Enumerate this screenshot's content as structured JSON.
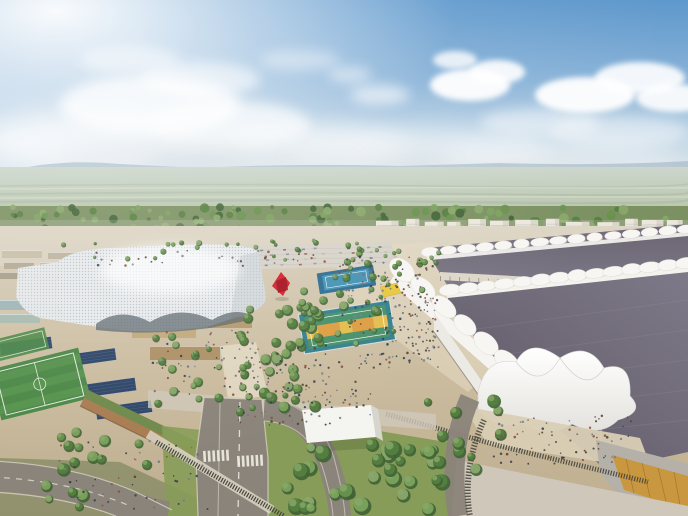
{
  "meta": {
    "scene": "aerial-architectural-rendering",
    "subject": "expo campus: white lattice pavilion, central park with sports courts, red sculpture, long exhibition halls with white tent roofs, apartment row on horizon, roads and gardens in foreground"
  },
  "seed": 20240717,
  "palette": {
    "skyTop": "#5e98cc",
    "skyMid": "#8ab3d8",
    "skyLow": "#c6d9e6",
    "skyHaze": "#e2eaee",
    "cloudGray": "#b9c6ce",
    "mountain": "#a9bbc7",
    "plainA": "#ccd6cc",
    "plainB": "#b2bfa1",
    "plainStreak": "#9cae92",
    "plainLight": "#e0e4d4",
    "forestBase": "#7c9162",
    "forestDark": "#5c744a",
    "aptWall": "#e9e4d8",
    "aptShade": "#c7c0b1",
    "aptWin": "#9aa1a9",
    "ground1": "#d8cfbc",
    "ground2": "#cbbc9f",
    "ground3": "#bfae90",
    "parking": "#d7d3c9",
    "parkLine": "#c3bfb4",
    "lattice": "#e8ebed",
    "latticeDot": "#98a1a8",
    "latticeShade": "#bfc7cc",
    "latticeDark": "#5d686e",
    "corridor": "#ddd7c9",
    "corridorCol": "#8d8678",
    "roofDark": "#57525f",
    "roofMid": "#6e6876",
    "roofLight": "#7e7988",
    "roofRidge": "#948e9e",
    "tentWhite": "#f7f6f3",
    "tentShade": "#d5d3cd",
    "hallWall": "#eceae4",
    "concrete": "#b5b1a8",
    "goldGlass": "#c9973f",
    "goldDark": "#8a6224",
    "plazaTan": "#d9cdb4",
    "paveLight": "#cfc8ba",
    "plazaBright": "#e2d8c2",
    "asphalt": "#8b847a",
    "curb": "#d8d2c4",
    "roadMark": "#efede6",
    "grass": "#879c58",
    "grassDark": "#6d8347",
    "hedge": "#6e7a52",
    "fenceDark": "#44453c",
    "fieldGreen": "#4c8847",
    "fieldLight": "#5e9a52",
    "solar": "#2f4566",
    "solarLine": "#49648c",
    "terracotta": "#a97c52",
    "vegRoof": "#6f8a4c",
    "greenhouse": "#9fb4b4",
    "courtBlueDark": "#2f6e92",
    "courtBlue": "#4493b4",
    "courtTeal": "#35818f",
    "courtGreen": "#47906a",
    "courtYellow": "#e3bd4e",
    "courtOrange": "#dd9a41",
    "red": "#d5202d",
    "redDark": "#a31220",
    "yellowCanopy": "#e8c83e",
    "boxWhite": "#f4f4f0",
    "boxShade": "#d6d6cf"
  },
  "clouds": [
    {
      "cx": 470,
      "cy": 85,
      "rx": 40,
      "ry": 16,
      "o": 0.95,
      "b": 3
    },
    {
      "cx": 497,
      "cy": 72,
      "rx": 28,
      "ry": 12,
      "o": 0.9,
      "b": 3
    },
    {
      "cx": 585,
      "cy": 95,
      "rx": 50,
      "ry": 18,
      "o": 0.95,
      "b": 3
    },
    {
      "cx": 640,
      "cy": 78,
      "rx": 45,
      "ry": 16,
      "o": 0.9,
      "b": 3
    },
    {
      "cx": 674,
      "cy": 98,
      "rx": 38,
      "ry": 14,
      "o": 0.9,
      "b": 3
    },
    {
      "cx": 455,
      "cy": 60,
      "rx": 22,
      "ry": 9,
      "o": 0.8,
      "b": 3
    },
    {
      "cx": 380,
      "cy": 95,
      "rx": 30,
      "ry": 10,
      "o": 0.6,
      "b": 6
    },
    {
      "cx": 350,
      "cy": 75,
      "rx": 22,
      "ry": 8,
      "o": 0.5,
      "b": 6
    },
    {
      "cx": 540,
      "cy": 122,
      "rx": 60,
      "ry": 14,
      "o": 0.5,
      "b": 6
    },
    {
      "cx": 620,
      "cy": 132,
      "rx": 70,
      "ry": 16,
      "o": 0.45,
      "b": 6
    },
    {
      "cx": 150,
      "cy": 105,
      "rx": 90,
      "ry": 30,
      "o": 0.8,
      "b": 6
    },
    {
      "cx": 230,
      "cy": 125,
      "rx": 80,
      "ry": 24,
      "o": 0.7,
      "b": 6
    },
    {
      "cx": 90,
      "cy": 140,
      "rx": 110,
      "ry": 28,
      "o": 0.75,
      "b": 12
    },
    {
      "cx": 290,
      "cy": 150,
      "rx": 120,
      "ry": 26,
      "o": 0.6,
      "b": 12
    },
    {
      "cx": 420,
      "cy": 152,
      "rx": 130,
      "ry": 24,
      "o": 0.5,
      "b": 12
    },
    {
      "cx": 560,
      "cy": 162,
      "rx": 120,
      "ry": 20,
      "o": 0.45,
      "b": 12
    },
    {
      "cx": 200,
      "cy": 80,
      "rx": 60,
      "ry": 18,
      "o": 0.6,
      "b": 6
    },
    {
      "cx": 300,
      "cy": 60,
      "rx": 40,
      "ry": 10,
      "o": 0.4,
      "b": 6
    },
    {
      "cx": 130,
      "cy": 60,
      "rx": 50,
      "ry": 14,
      "o": 0.5,
      "b": 6
    },
    {
      "cx": 300,
      "cy": 162,
      "rx": 150,
      "ry": 13,
      "o": 0.3,
      "b": 12,
      "g": 1
    },
    {
      "cx": 520,
      "cy": 168,
      "rx": 150,
      "ry": 11,
      "o": 0.28,
      "b": 12,
      "g": 1
    },
    {
      "cx": 150,
      "cy": 152,
      "rx": 100,
      "ry": 12,
      "o": 0.3,
      "b": 12,
      "g": 1
    }
  ],
  "forest": {
    "x1": 0,
    "x2": 688,
    "yTop": 207,
    "yBot": 236,
    "n": 160
  },
  "apartments": {
    "x1": 376,
    "x2": 688,
    "baseY": 233,
    "minW": 12,
    "maxW": 24,
    "minH": 9,
    "maxH": 15,
    "minGap": 3,
    "maxGap": 8,
    "frontTrees": 46
  },
  "parking": {
    "rows": [
      {
        "x1": 138,
        "y1": 253,
        "x2": 392,
        "y2": 247
      },
      {
        "x1": 135,
        "y1": 258,
        "x2": 396,
        "y2": 252
      },
      {
        "x1": 131,
        "y1": 263,
        "x2": 398,
        "y2": 257
      },
      {
        "x1": 127,
        "y1": 268,
        "x2": 400,
        "y2": 262
      }
    ],
    "perRow": 15,
    "carColors": [
      "#aaa9a4",
      "#8f949c",
      "#b9b4a9",
      "#7c828c",
      "#c2bdb2",
      "#6d7480",
      "#9a5f52"
    ]
  },
  "leftBlocks": [
    {
      "x": 2,
      "y": 250,
      "w": 40,
      "h": 8,
      "c": "#c9bfa8"
    },
    {
      "x": 48,
      "y": 252,
      "w": 34,
      "h": 7,
      "c": "#bdb49e"
    },
    {
      "x": 4,
      "y": 262,
      "w": 30,
      "h": 7,
      "c": "#b3ab95"
    },
    {
      "x": 40,
      "y": 262,
      "w": 26,
      "h": 6,
      "c": "#c4bba4"
    },
    {
      "x": 0,
      "y": 272,
      "w": 26,
      "h": 7,
      "c": "#a99f88"
    },
    {
      "x": 30,
      "y": 274,
      "w": 34,
      "h": 7,
      "c": "#b8ae96"
    },
    {
      "x": 70,
      "y": 260,
      "w": 22,
      "h": 6,
      "c": "#c0b79f"
    },
    {
      "x": 96,
      "y": 254,
      "w": 26,
      "h": 6,
      "c": "#cdc4ac"
    },
    {
      "x": 0,
      "y": 300,
      "w": 46,
      "h": 10,
      "c": "#9fb4b6"
    },
    {
      "x": 0,
      "y": 314,
      "w": 40,
      "h": 9,
      "c": "#a9bcb0"
    },
    {
      "x": 50,
      "y": 306,
      "w": 36,
      "h": 9,
      "c": "#95aaa8"
    },
    {
      "x": 132,
      "y": 322,
      "w": 64,
      "h": 16,
      "c": "#c2a97c"
    },
    {
      "x": 208,
      "y": 316,
      "w": 44,
      "h": 12,
      "c": "#b59a6e"
    },
    {
      "x": 150,
      "y": 346,
      "w": 70,
      "h": 14,
      "c": "#ad9166"
    }
  ],
  "solarGroups": [
    {
      "x": 0,
      "y": 340,
      "w": 52,
      "h": 12,
      "rot": -8
    },
    {
      "x": 58,
      "y": 352,
      "w": 58,
      "h": 12,
      "rot": -8
    },
    {
      "x": 6,
      "y": 368,
      "w": 58,
      "h": 13,
      "rot": -8
    },
    {
      "x": 70,
      "y": 382,
      "w": 66,
      "h": 13,
      "rot": -8
    },
    {
      "x": 0,
      "y": 396,
      "w": 40,
      "h": 12,
      "rot": -8
    },
    {
      "x": 96,
      "y": 404,
      "w": 56,
      "h": 12,
      "rot": -8
    }
  ],
  "tentBands": [
    {
      "x1": 430,
      "y1": 252,
      "x2": 686,
      "y2": 229,
      "n": 15,
      "rx": 8.5,
      "ry": 4.5
    },
    {
      "x1": 450,
      "y1": 290,
      "x2": 686,
      "y2": 263,
      "n": 14,
      "rx": 10,
      "ry": 5.5
    },
    {
      "x1": 402,
      "y1": 270,
      "x2": 528,
      "y2": 380,
      "n": 7,
      "rx": 14,
      "ry": 9
    }
  ],
  "corridor": {
    "x1": 440,
    "y1": 276,
    "x2": 622,
    "y2": 286,
    "n": 20
  },
  "crosswalks": [
    {
      "x": 203,
      "y": 451,
      "n": 6,
      "dx": 4.6,
      "w": 2.6,
      "h": 11,
      "rot": -3
    },
    {
      "x": 237,
      "y": 456,
      "n": 6,
      "dx": 4.6,
      "w": 2.6,
      "h": 11,
      "rot": -3
    }
  ],
  "treePalette": [
    "#3f6335",
    "#54803f",
    "#68924e",
    "#7ba35c",
    "#8aa86b"
  ],
  "treeClusters": [
    {
      "x": 240,
      "y": 300,
      "w": 80,
      "h": 108,
      "n": 42,
      "rmin": 3,
      "rmax": 6
    },
    {
      "x": 330,
      "y": 252,
      "w": 100,
      "h": 50,
      "n": 22,
      "rmin": 2,
      "rmax": 4
    },
    {
      "x": 296,
      "y": 290,
      "w": 100,
      "h": 60,
      "n": 16,
      "rmin": 2.5,
      "rmax": 5
    },
    {
      "x": 150,
      "y": 330,
      "w": 110,
      "h": 90,
      "n": 18,
      "rmin": 2.5,
      "rmax": 5
    },
    {
      "x": 40,
      "y": 430,
      "w": 120,
      "h": 78,
      "n": 16,
      "rmin": 4,
      "rmax": 7
    },
    {
      "x": 286,
      "y": 428,
      "w": 156,
      "h": 84,
      "n": 30,
      "rmin": 5,
      "rmax": 9
    },
    {
      "x": 420,
      "y": 400,
      "w": 86,
      "h": 70,
      "n": 13,
      "rmin": 4,
      "rmax": 7
    },
    {
      "x": 60,
      "y": 240,
      "w": 330,
      "h": 20,
      "n": 30,
      "rmin": 1.5,
      "rmax": 3
    },
    {
      "x": 388,
      "y": 250,
      "w": 52,
      "h": 40,
      "n": 8,
      "rmin": 2,
      "rmax": 3.5
    }
  ],
  "crowdPalette": [
    "#3a3f4a",
    "#6b6f78",
    "#8a4a3a",
    "#2f3a4f",
    "#7a7f88",
    "#55402e"
  ],
  "crowdRegions": [
    {
      "x": 338,
      "y": 256,
      "w": 100,
      "h": 112,
      "n": 150
    },
    {
      "x": 236,
      "y": 344,
      "w": 95,
      "h": 82,
      "n": 90
    },
    {
      "x": 150,
      "y": 330,
      "w": 108,
      "h": 66,
      "n": 50
    },
    {
      "x": 58,
      "y": 440,
      "w": 150,
      "h": 70,
      "n": 55
    },
    {
      "x": 492,
      "y": 414,
      "w": 140,
      "h": 50,
      "n": 70
    },
    {
      "x": 96,
      "y": 250,
      "w": 270,
      "h": 16,
      "n": 35
    },
    {
      "x": 400,
      "y": 292,
      "w": 40,
      "h": 70,
      "n": 40
    },
    {
      "x": 296,
      "y": 380,
      "w": 80,
      "h": 38,
      "n": 28
    }
  ]
}
